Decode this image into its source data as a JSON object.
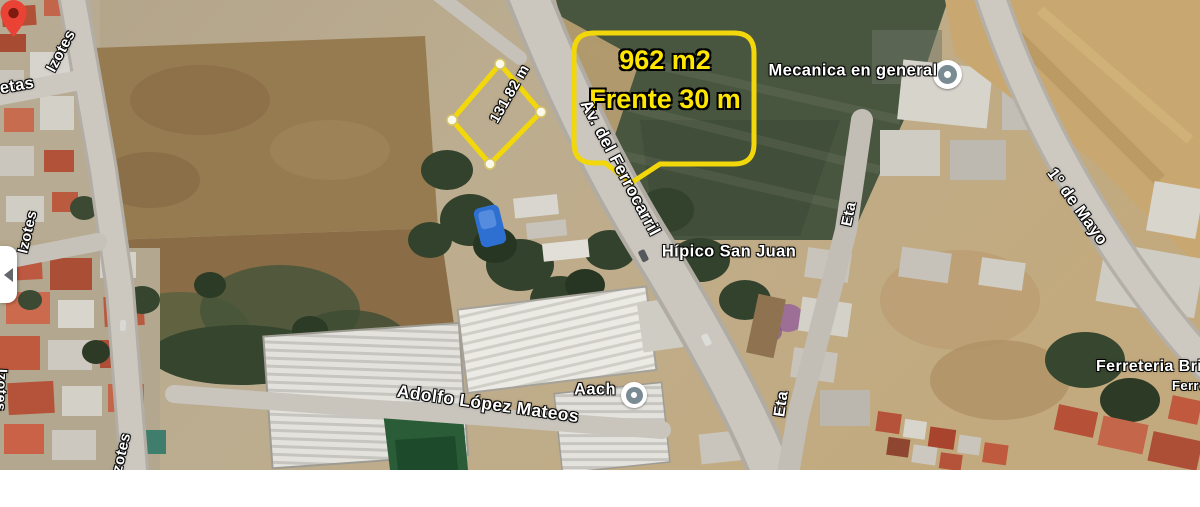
{
  "annotation": {
    "area": "962 m2",
    "frontage": "Frente 30 m",
    "measurement": "131.82 m",
    "outline_color": "#f2d70a",
    "text_color": "#ffe600"
  },
  "pois": {
    "mecanica": {
      "label": "Mecanica en general"
    },
    "hipico": {
      "label": "Hípico San Juan"
    },
    "aach": {
      "label": "Aach"
    },
    "ferreteria": {
      "label": "Ferreteria Bris",
      "sublabel": "Ferre"
    }
  },
  "streets": {
    "ferrocarril": "Av. del Ferrocarril",
    "adolfo_lopez_mateos": "Adolfo López Mateos",
    "izotes_top": "Izotes",
    "izotes_mid": "Izotes",
    "izotes_left_edge": "Izotes",
    "izotes_bottom": "Izotes",
    "etas_fragment": "etas",
    "eta_north": "Eta",
    "eta_south": "Eta",
    "primero_de_mayo": "1° de Mayo"
  },
  "colors": {
    "pin_red": "#ea4335",
    "poi_icon_gray": "#7b8b94",
    "annotation_yellow": "#f2d70a"
  }
}
